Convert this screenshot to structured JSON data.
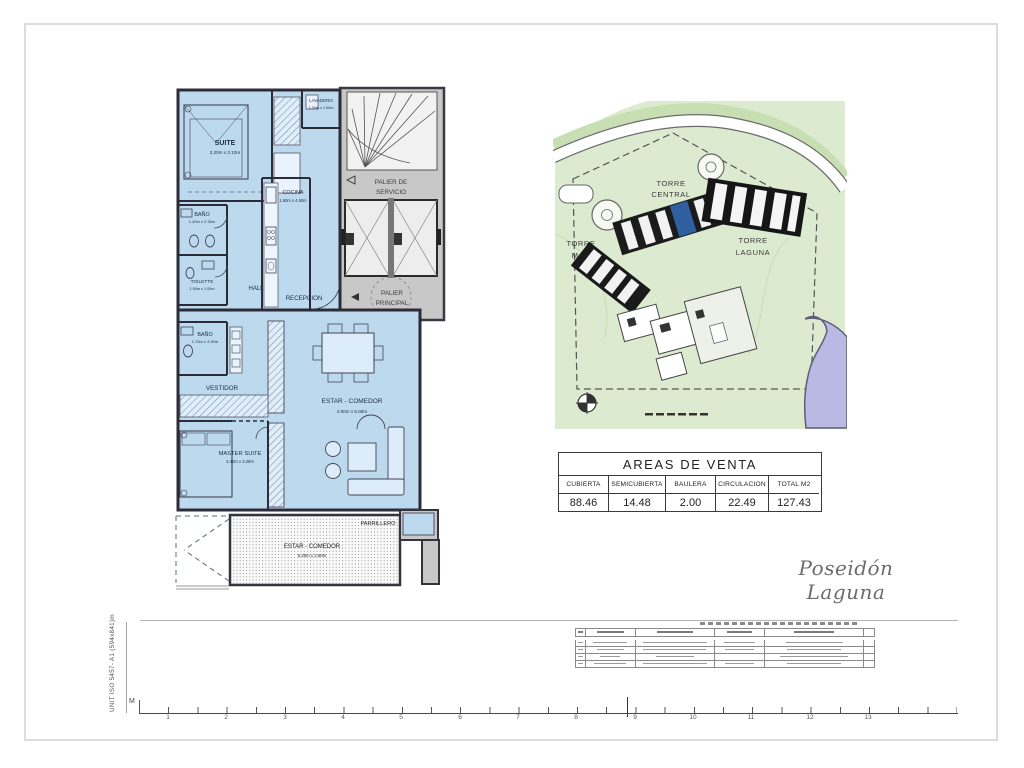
{
  "sheet": {
    "signature": "Poseidón Laguna",
    "vertical_note": "UNIT ISO 5457- A1 (594x841)m",
    "ruler": {
      "m_label": "M",
      "numbers": [
        "1",
        "2",
        "3",
        "4",
        "5",
        "6",
        "7",
        "8",
        "9",
        "10",
        "11",
        "12",
        "13"
      ]
    }
  },
  "floor_plan": {
    "suite": {
      "name": "SUITE",
      "dims": "3.20m x 3.10m"
    },
    "lavadero": {
      "name": "LAVADERO",
      "dims": "1.30m x 1.00m"
    },
    "bano1": {
      "name": "BAÑO",
      "dims": "1.40m x 2.30m"
    },
    "toilette": {
      "name": "TOILETTE",
      "dims": "1.50m x 1.00m"
    },
    "hall": {
      "name": "HALL"
    },
    "recepcion": {
      "name": "RECEPCION"
    },
    "cocina": {
      "name": "COCINA",
      "dims": "1.60m x 4.50m"
    },
    "palier_servicio": {
      "line1": "PALIER DE",
      "line2": "SERVICIO"
    },
    "palier_principal": {
      "line1": "PALIER",
      "line2": "PRINCIPAL"
    },
    "bano2": {
      "name": "BAÑO",
      "dims": "1.70m x 3.30m"
    },
    "vestidor": {
      "name": "VESTIDOR"
    },
    "master_suite": {
      "name": "MASTER SUITE",
      "dims": "3.40m x 3.20m"
    },
    "estar_comedor": {
      "name": "ESTAR - COMEDOR",
      "dims": "4.00m x 6.00m"
    },
    "terraza": {
      "name": "ESTAR - COMEDOR",
      "dims": "5.20m x 2.50m"
    },
    "parrillero": {
      "name": "PARRILLERO"
    },
    "colors": {
      "room_fill": "#bdd9ee",
      "common_fill": "#c8c8c8",
      "wall": "#2c2c38"
    }
  },
  "site_plan": {
    "torre_central": {
      "line1": "TORRE",
      "line2": "CENTRAL"
    },
    "torre_mar": {
      "line1": "TORRE",
      "line2": "MAR"
    },
    "torre_laguna": {
      "line1": "TORRE",
      "line2": "LAGUNA"
    },
    "colors": {
      "ground": "#dcebcf",
      "lagoon": "#b9b9e4",
      "highlight_unit": "#2f5f9e"
    }
  },
  "areas_table": {
    "title": "AREAS DE VENTA",
    "columns": [
      "CUBIERTA",
      "SEMICUBIERTA",
      "BAULERA",
      "CIRCULACION",
      "TOTAL M2"
    ],
    "values": [
      "88.46",
      "14.48",
      "2.00",
      "22.49",
      "127.43"
    ]
  }
}
